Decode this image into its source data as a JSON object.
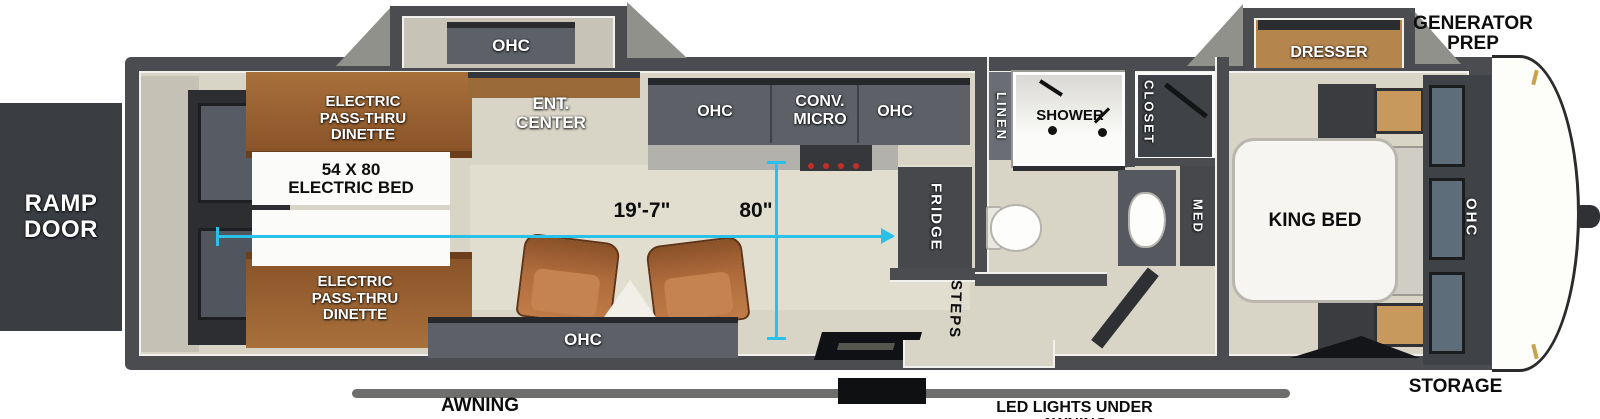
{
  "labels": {
    "ramp_door": "RAMP\nDOOR",
    "generator_prep": "GENERATOR\nPREP",
    "storage": "STORAGE",
    "awning": "AWNING",
    "led_lights": "LED LIGHTS UNDER AWNING"
  },
  "rear": {
    "dinette_top": "ELECTRIC\nPASS-THRU\nDINETTE",
    "dinette_bottom": "ELECTRIC\nPASS-THRU\nDINETTE",
    "electric_bed": "54 X 80\nELECTRIC BED"
  },
  "living": {
    "slide_ohc": "OHC",
    "ent_center": "ENT.\nCENTER",
    "sofa_ohc": "OHC"
  },
  "kitchen": {
    "ohc_left": "OHC",
    "conv_micro": "CONV.\nMICRO",
    "ohc_right": "OHC",
    "fridge": "FRIDGE"
  },
  "bath": {
    "linen": "LINEN",
    "shower": "SHOWER",
    "closet": "CLOSET",
    "med": "MED",
    "steps": "STEPS"
  },
  "bedroom": {
    "dresser": "DRESSER",
    "king_bed": "KING BED",
    "wardrobe_ohc": "OHC"
  },
  "dimensions": {
    "interior_length": "19'-7\"",
    "interior_width": "80\""
  },
  "colors": {
    "dimension_line": "#2bc0e8",
    "wall": "#4b4c4f",
    "floor": "#d8d4c6",
    "wood": "#9a6a38",
    "cabinet": "#5d6167",
    "wood_light": "#c8995d"
  }
}
